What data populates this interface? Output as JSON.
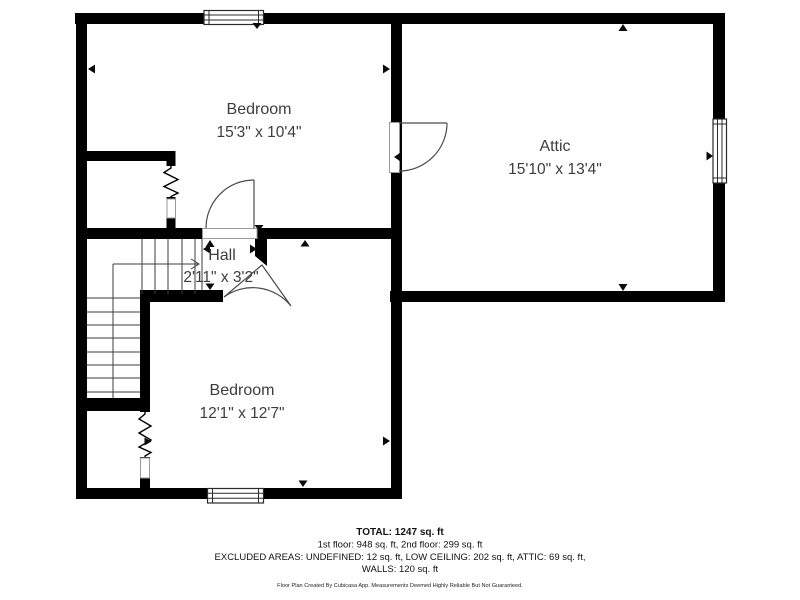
{
  "meta": {
    "background_color": "#ffffff",
    "wall_color": "#000000",
    "label_color": "#3d3d3d"
  },
  "rooms": [
    {
      "name": "Bedroom",
      "dims": "15'3\" x 10'4\""
    },
    {
      "name": "Attic",
      "dims": "15'10\" x 13'4\""
    },
    {
      "name": "Hall",
      "dims": "2'11\" x 3'2\""
    },
    {
      "name": "Bedroom",
      "dims": "12'1\" x 12'7\""
    }
  ],
  "summary": {
    "total": "TOTAL: 1247 sq. ft",
    "floors": "1st floor: 948 sq. ft, 2nd floor: 299 sq. ft",
    "excluded": "EXCLUDED AREAS: UNDEFINED: 12 sq. ft, LOW CEILING: 202 sq. ft, ATTIC: 69 sq. ft,",
    "walls": "WALLS: 120 sq. ft"
  },
  "disclaimer": "Floor Plan Created By Cubicasa App. Measurements Deemed Highly Reliable But Not Guaranteed."
}
